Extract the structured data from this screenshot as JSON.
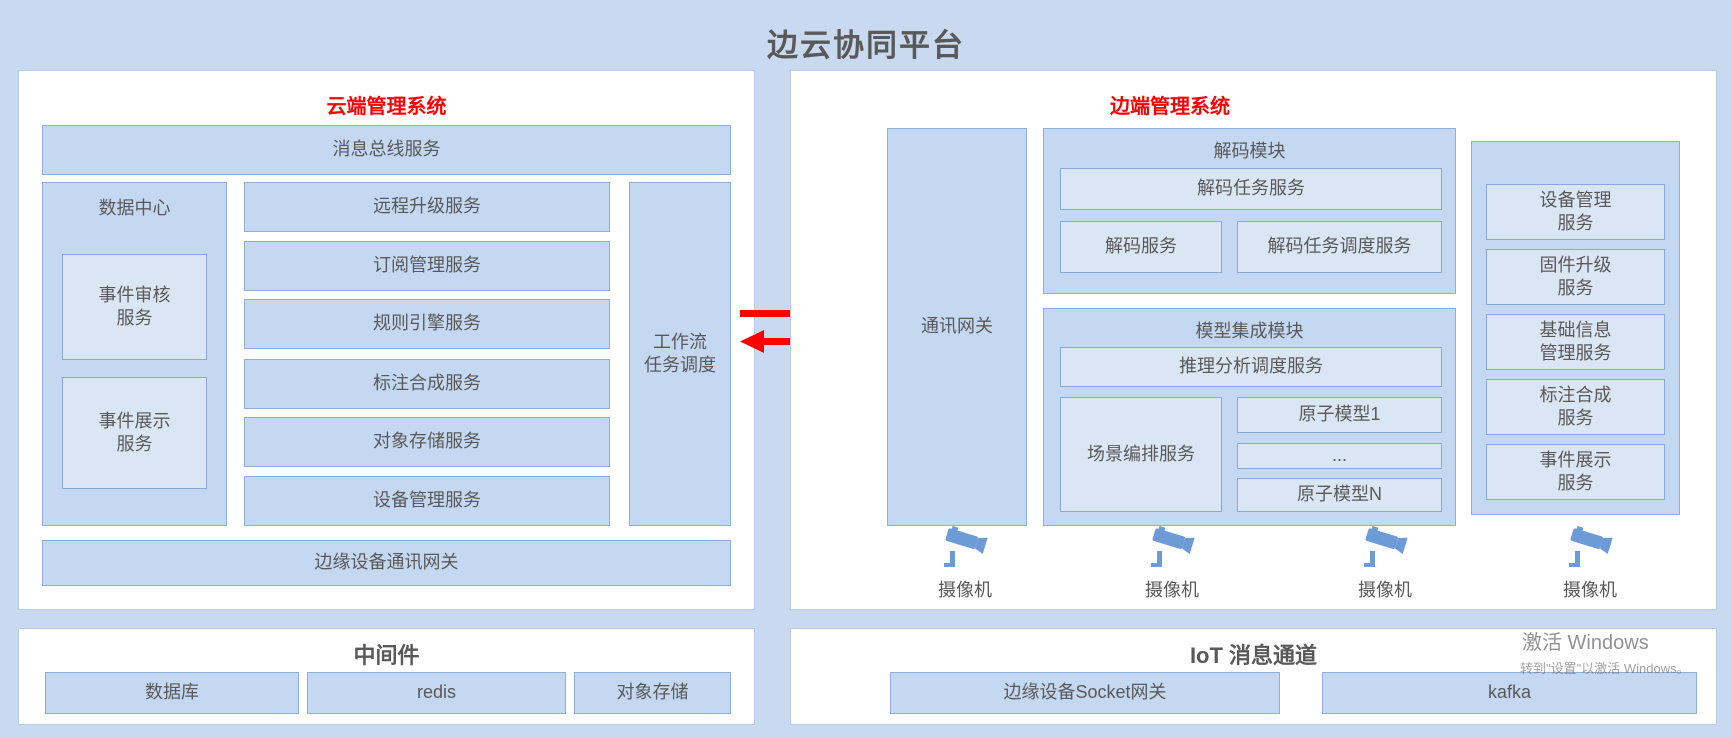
{
  "page": {
    "title": "边云协同平台"
  },
  "colors": {
    "background": "#c9d9ef",
    "panel_bg": "#ffffff",
    "box_fill": "#c5d8f1",
    "box_border": "#8fafd9",
    "inner_box_fill": "#dbe6f4",
    "accent_red": "#ff0000",
    "text_gray": "#595959",
    "camera_blue": "#6d9bd7"
  },
  "cloud": {
    "title": "云端管理系统",
    "bus": "消息总线服务",
    "data_center": {
      "label": "数据中心",
      "event_audit": [
        "事件审核",
        "服务"
      ],
      "event_display": [
        "事件展示",
        "服务"
      ]
    },
    "services": [
      "远程升级服务",
      "订阅管理服务",
      "规则引擎服务",
      "标注合成服务",
      "对象存储服务",
      "设备管理服务"
    ],
    "workflow": [
      "工作流",
      "任务调度"
    ],
    "edge_gateway": "边缘设备通讯网关"
  },
  "middleware": {
    "title": "中间件",
    "items": [
      "数据库",
      "redis",
      "对象存储"
    ]
  },
  "edge": {
    "title": "边端管理系统",
    "comm_gateway": "通讯网关",
    "decode": {
      "label": "解码模块",
      "task_service": "解码任务服务",
      "service": "解码服务",
      "task_scheduler": "解码任务调度服务"
    },
    "model": {
      "label": "模型集成模块",
      "inference_scheduler": "推理分析调度服务",
      "scene_orchestration": "场景编排服务",
      "atoms": [
        "原子模型1",
        "...",
        "原子模型N"
      ]
    },
    "device_services": [
      [
        "设备管理",
        "服务"
      ],
      [
        "固件升级",
        "服务"
      ],
      [
        "基础信息",
        "管理服务"
      ],
      [
        "标注合成",
        "服务"
      ],
      [
        "事件展示",
        "服务"
      ]
    ],
    "camera_label": "摄像机"
  },
  "iot": {
    "title": "IoT 消息通道",
    "items": [
      "边缘设备Socket网关",
      "kafka"
    ]
  },
  "watermark": {
    "line1": "激活 Windows",
    "line2": "转到\"设置\"以激活 Windows。"
  }
}
